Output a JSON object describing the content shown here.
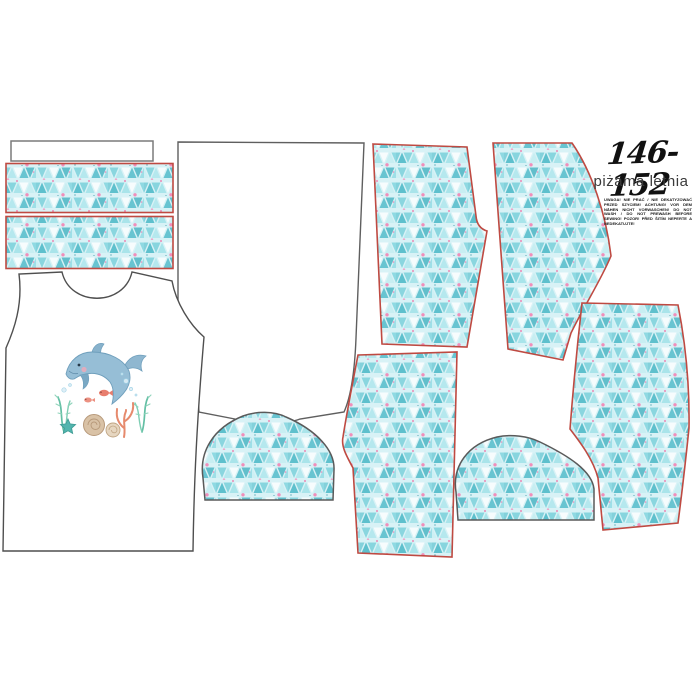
{
  "header": {
    "size_label": "146-152",
    "product_name": "piżama letnia",
    "care_warning": "UWAGA! NIE PRAĆ / NIE DEKATYZOWAĆ PRZED SZYCIEM! ACHTUNG! VOR DEM NÄHEN NICHT VORWASCHEN! DO NOT WASH / DO NOT PREWASH BEFORE SEWING! POZOR! PŘED ŠITÍM NEPERTE A NEDEKATUJTE!"
  },
  "colors": {
    "canvas_background": "#ffffff",
    "pattern_background": "#d8f2f6",
    "pattern_triangle_dark_teal": "#49b7c6",
    "pattern_triangle_light_teal": "#a9e4ea",
    "pattern_accent_pink": "#f283b4",
    "cut_line_red": "#bf4a42",
    "cut_line_gray": "#5f5f5f",
    "text_color": "#111111"
  },
  "pieces": [
    {
      "name": "neckband-strip-white",
      "outline": "gray",
      "fill": "white"
    },
    {
      "name": "pattern-strip-1",
      "outline": "red",
      "fill": "triangle-pattern"
    },
    {
      "name": "pattern-strip-2",
      "outline": "red",
      "fill": "triangle-pattern"
    },
    {
      "name": "tank-top-front-piece",
      "outline": "gray",
      "fill": "white",
      "print": "dolphin-graphic"
    },
    {
      "name": "tank-top-back-piece",
      "outline": "gray",
      "fill": "white"
    },
    {
      "name": "curved-panel-piece-1",
      "outline": "gray",
      "fill": "triangle-pattern"
    },
    {
      "name": "curved-panel-piece-2",
      "outline": "gray",
      "fill": "triangle-pattern"
    },
    {
      "name": "shorts-front-leg-piece-1",
      "outline": "red",
      "fill": "triangle-pattern"
    },
    {
      "name": "shorts-back-leg-piece-1",
      "outline": "red",
      "fill": "triangle-pattern"
    },
    {
      "name": "shorts-front-leg-piece-2",
      "outline": "red",
      "fill": "triangle-pattern"
    },
    {
      "name": "shorts-back-leg-piece-2",
      "outline": "red",
      "fill": "triangle-pattern"
    }
  ],
  "graphic": {
    "name": "dolphin-with-corals-graphic",
    "elements": [
      "dolphin",
      "bubbles",
      "two-fish",
      "seaweed",
      "starfish",
      "shells",
      "coral-branch"
    ]
  }
}
